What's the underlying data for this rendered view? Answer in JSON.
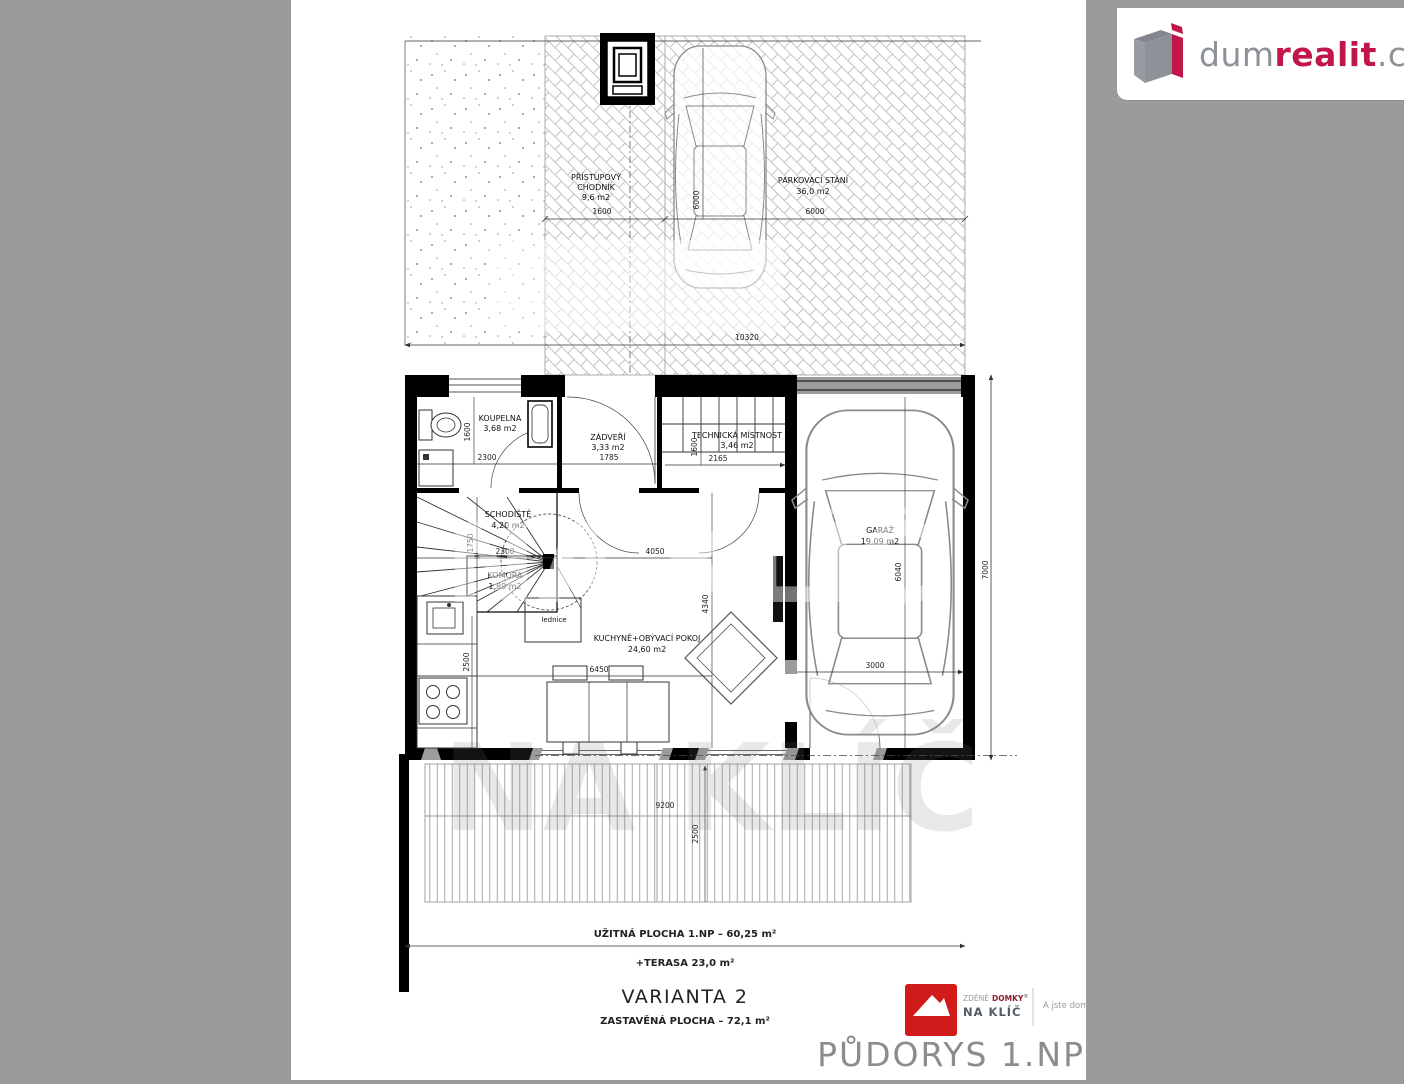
{
  "header": {
    "brand_dum": "dum",
    "brand_realit": "realit",
    "brand_cz": ".cz"
  },
  "colors": {
    "band_gray": "#9b9b9b",
    "brand_red": "#c11649",
    "brand_gray": "#8d9198",
    "naklic_red": "#d11a1a",
    "title_gray": "#8c8c8c"
  },
  "plan": {
    "rooms": {
      "chodnik": [
        "PŘÍSTUPOVÝ",
        "CHODNÍK",
        "9,6 m2"
      ],
      "parkovani": [
        "PARKOVACÍ STÁNÍ",
        "36,0 m2"
      ],
      "koupelna": [
        "KOUPELNA",
        "3,68 m2"
      ],
      "zadveri": [
        "ZÁDVEŘÍ",
        "3,33 m2"
      ],
      "technicka": [
        "TECHNICKÁ MÍSTNOST",
        "3,46 m2"
      ],
      "schodiste": [
        "SCHODIŠTĚ",
        "4,20 m2"
      ],
      "komora": [
        "KOMORA",
        "1,89 m2"
      ],
      "kuchyn": [
        "KUCHYNĚ+OBÝVACÍ POKOJ",
        "24,60 m2"
      ],
      "garaz": [
        "GARÁŽ",
        "19,09 m2"
      ],
      "lednice": "lednice"
    },
    "dims": {
      "chodnik_w": "1600",
      "parking_w": "6000",
      "parking_h": "6000",
      "paving_w": "10320",
      "koupelna_w": "2300",
      "koupelna_h": "1600",
      "zadveri_w": "1785",
      "tech_w": "2165",
      "tech_h": "1600",
      "schodiste_w": "2300",
      "schodiste_h": "1750",
      "kuchyn_left_h": "2500",
      "kuchyn_w": "4050",
      "kuchyn_total_w": "6450",
      "kuchyn_h": "4340",
      "garaz_w": "3000",
      "garaz_h": "6040",
      "house_h": "7000",
      "terasa_w": "9200",
      "terasa_h": "2500"
    },
    "watermark": "NA KLÍČ"
  },
  "summary": {
    "uzitna": "UŽITNÁ PLOCHA 1.NP – 60,25 m²",
    "terasa": "+TERASA 23,0 m²",
    "varianta": "VARIANTA 2",
    "zastavena": "ZASTAVĚNÁ PLOCHA – 72,1 m²"
  },
  "footer": {
    "naklic_line1a": "ZDĚNÉ",
    "naklic_line1b": "DOMKY",
    "naklic_reg": "®",
    "naklic_line2": "NA KLÍČ",
    "tagline": "A jste doma.",
    "title": "PŮDORYS 1.NP"
  }
}
